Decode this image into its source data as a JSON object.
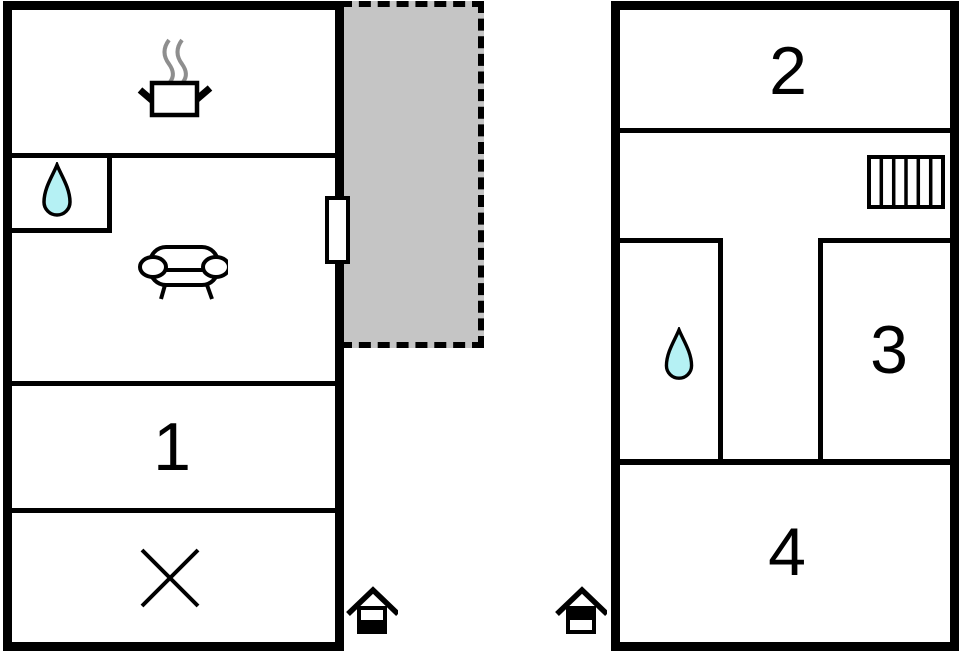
{
  "plan": {
    "type": "floorplan",
    "labels": {
      "room1": "1",
      "room2": "2",
      "room3": "3",
      "room4": "4"
    },
    "colors": {
      "wall": "#000000",
      "background": "#ffffff",
      "terrace_fill": "#c5c5c5",
      "water_drop_fill": "#b5f1f4",
      "steam_gray": "#8e8e8e"
    },
    "left_building": {
      "rooms": [
        {
          "name": "kitchen",
          "icon": "cooking-pot-icon"
        },
        {
          "name": "bathroom",
          "icon": "water-drop-icon"
        },
        {
          "name": "living-room",
          "icon": "sofa-icon"
        },
        {
          "name": "room-1",
          "label": "1"
        },
        {
          "name": "stairs-room",
          "icon": "cross-icon"
        }
      ],
      "door": "terrace-door",
      "floor_marker": "house-lower-half-filled-icon"
    },
    "right_building": {
      "rooms": [
        {
          "name": "room-2",
          "label": "2"
        },
        {
          "name": "hall",
          "icon": "radiator-icon"
        },
        {
          "name": "bathroom",
          "icon": "water-drop-icon"
        },
        {
          "name": "room-3",
          "label": "3"
        },
        {
          "name": "room-4",
          "label": "4"
        }
      ],
      "floor_marker": "house-upper-half-filled-icon"
    },
    "terrace": {
      "name": "terrace",
      "border": "dashed"
    }
  }
}
